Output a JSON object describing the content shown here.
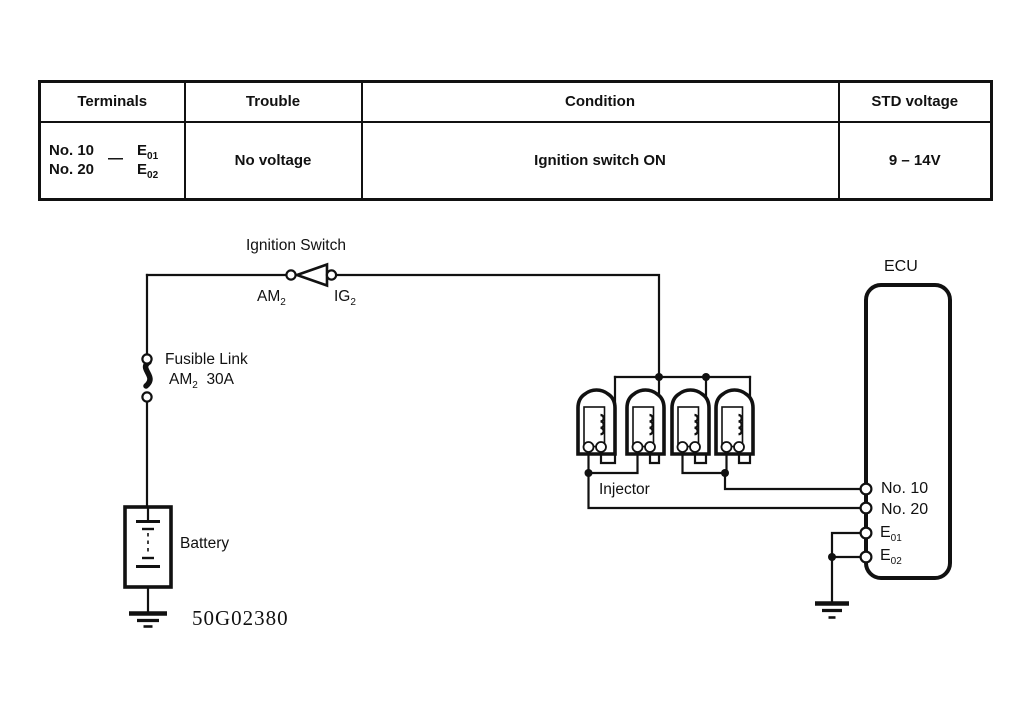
{
  "colors": {
    "ink": "#111111",
    "background": "#ffffff"
  },
  "table": {
    "headers": [
      "Terminals",
      "Trouble",
      "Condition",
      "STD voltage"
    ],
    "row": {
      "terminal_pairs": {
        "left": [
          "No. 10",
          "No. 20"
        ],
        "separator": "—",
        "right": [
          {
            "main": "E",
            "sub": "01"
          },
          {
            "main": "E",
            "sub": "02"
          }
        ]
      },
      "trouble": "No voltage",
      "condition": "Ignition switch ON",
      "std_voltage": "9 – 14V"
    }
  },
  "diagram": {
    "ignition_switch_label": "Ignition Switch",
    "am2": {
      "main": "AM",
      "sub": "2"
    },
    "ig2": {
      "main": "IG",
      "sub": "2"
    },
    "fusible_link": {
      "line1": "Fusible Link",
      "line2_main": "AM",
      "line2_sub": "2",
      "line2_rest": "30A"
    },
    "battery_label": "Battery",
    "injector_label": "Injector",
    "ecu_label": "ECU",
    "ecu_terminals": {
      "no10": "No. 10",
      "no20": "No. 20",
      "e01": {
        "main": "E",
        "sub": "01"
      },
      "e02": {
        "main": "E",
        "sub": "02"
      }
    },
    "figure_code": "50G02380"
  }
}
